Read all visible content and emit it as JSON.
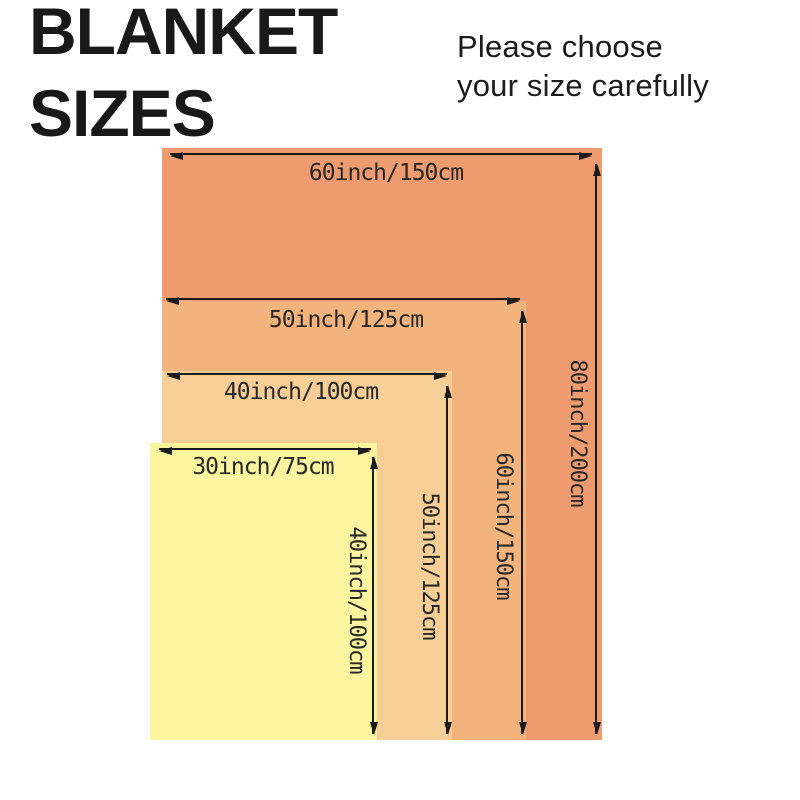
{
  "page": {
    "title_lines": [
      "BLANKET",
      "SIZES"
    ],
    "subtitle_lines": [
      "Please choose",
      "your size carefully"
    ]
  },
  "colors": {
    "background": "#ffffff",
    "text": "#191919",
    "arrow": "#1b1b1b",
    "label_text": "#282828"
  },
  "diagram": {
    "blankets": [
      {
        "size_name": "60x80",
        "width_label": "60inch/150cm",
        "height_label": "80inch/200cm",
        "width_in": 60,
        "height_in": 80,
        "width_cm": 150,
        "height_cm": 200,
        "color": "#EE9C6F",
        "rect": {
          "left": 162,
          "top": 148,
          "width": 440,
          "height": 592
        },
        "width_arrow": {
          "y": 154,
          "x1": 170,
          "x2": 592,
          "label_cx": 386,
          "label_top": 161
        },
        "height_arrow": {
          "x": 596,
          "y1": 164,
          "y2": 734,
          "label_cx": 577,
          "label_cy": 433
        }
      },
      {
        "size_name": "50x60",
        "width_label": "50inch/125cm",
        "height_label": "60inch/150cm",
        "width_in": 50,
        "height_in": 60,
        "width_cm": 125,
        "height_cm": 150,
        "color": "#F3B37C",
        "rect": {
          "left": 162,
          "top": 301,
          "width": 364,
          "height": 439
        },
        "width_arrow": {
          "y": 299,
          "x1": 166,
          "x2": 520,
          "label_cx": 346,
          "label_top": 308
        },
        "height_arrow": {
          "x": 522,
          "y1": 311,
          "y2": 734,
          "label_cx": 503,
          "label_cy": 526
        }
      },
      {
        "size_name": "40x50",
        "width_label": "40inch/100cm",
        "height_label": "50inch/125cm",
        "width_in": 40,
        "height_in": 50,
        "width_cm": 100,
        "height_cm": 125,
        "color": "#F7CE96",
        "rect": {
          "left": 162,
          "top": 371,
          "width": 290,
          "height": 369
        },
        "width_arrow": {
          "y": 374,
          "x1": 167,
          "x2": 447,
          "label_cx": 301,
          "label_top": 380
        },
        "height_arrow": {
          "x": 447,
          "y1": 386,
          "y2": 734,
          "label_cx": 429,
          "label_cy": 566
        }
      },
      {
        "size_name": "30x40",
        "width_label": "30inch/75cm",
        "height_label": "40inch/100cm",
        "width_in": 30,
        "height_in": 40,
        "width_cm": 75,
        "height_cm": 100,
        "color": "#FAF59E",
        "rect": {
          "left": 150,
          "top": 443,
          "width": 227,
          "height": 297
        },
        "width_arrow": {
          "y": 449,
          "x1": 159,
          "x2": 371,
          "label_cx": 263,
          "label_top": 455
        },
        "height_arrow": {
          "x": 373,
          "y1": 457,
          "y2": 734,
          "label_cx": 356,
          "label_cy": 600
        }
      }
    ]
  }
}
